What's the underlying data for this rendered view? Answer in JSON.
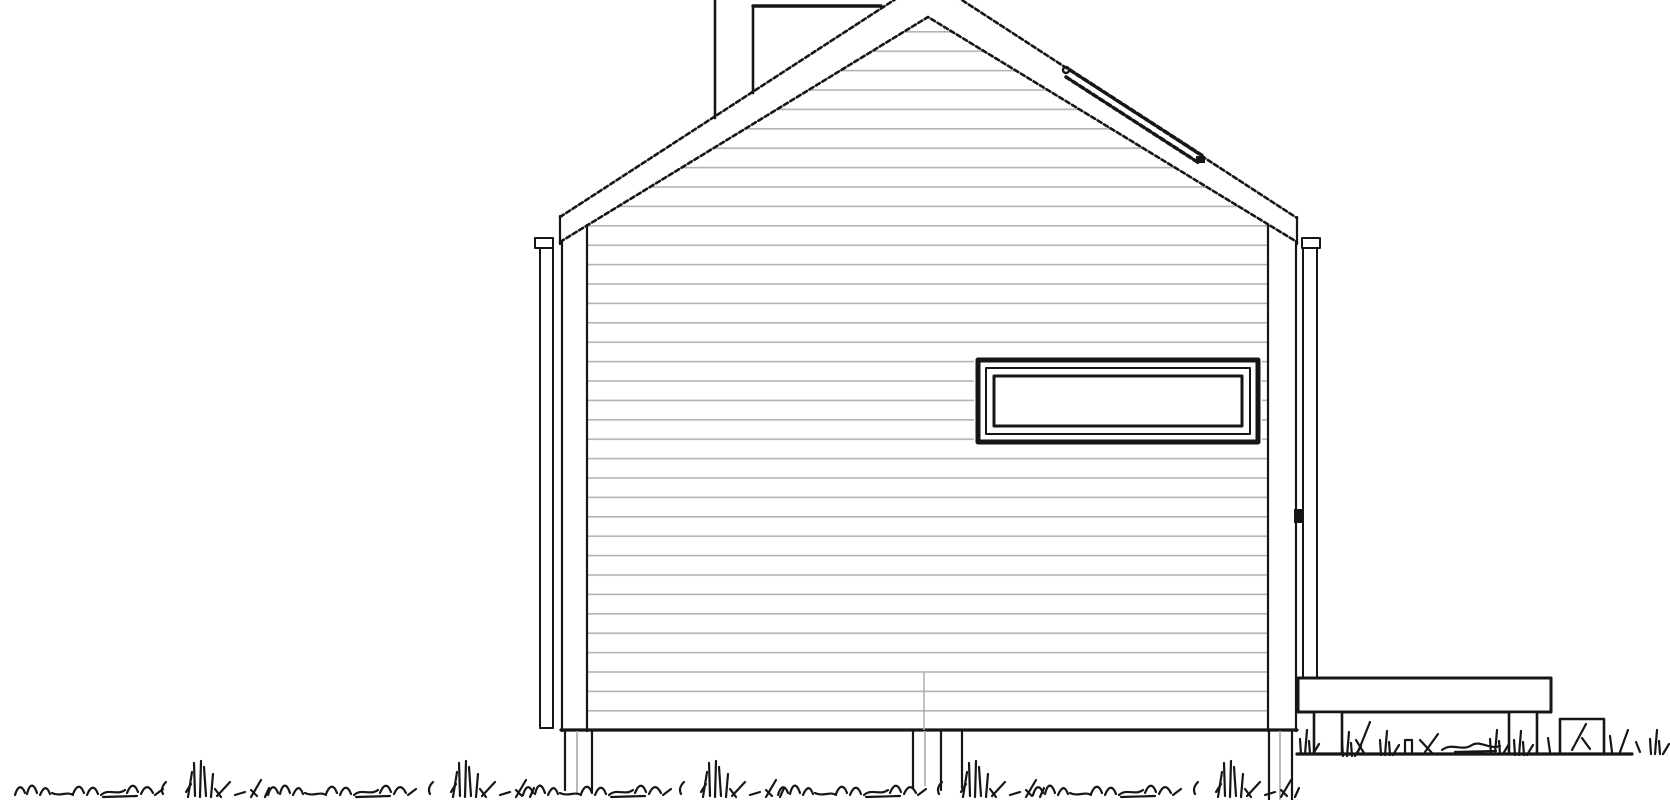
{
  "canvas": {
    "width": 1670,
    "height": 800
  },
  "palette": {
    "background": "#ffffff",
    "line": "#161616",
    "siding_line": "#b3b3b3",
    "pad_fill": "#c2c2c2"
  },
  "drawing": {
    "kind": "architectural-elevation",
    "elements": {
      "roof": "gable-roof-with-rake-band",
      "chimney": "chimney-stack-behind-roof",
      "roof_flashing": "roof-window-flashing-on-right-slope",
      "wall": "horizontal-clapboard-siding",
      "corner_trim": "corner-boards-left-and-right",
      "gutter_left": "gutter-outlet-and-downspout-left",
      "gutter_right": "gutter-outlet-and-downspout-right",
      "window": "horizontal-strip-window",
      "foundation": "foundation-piers-below-floor",
      "deck": "deck-slab-on-two-posts",
      "pad": "concrete-pad",
      "ground": "ground-line-and-grass"
    }
  }
}
